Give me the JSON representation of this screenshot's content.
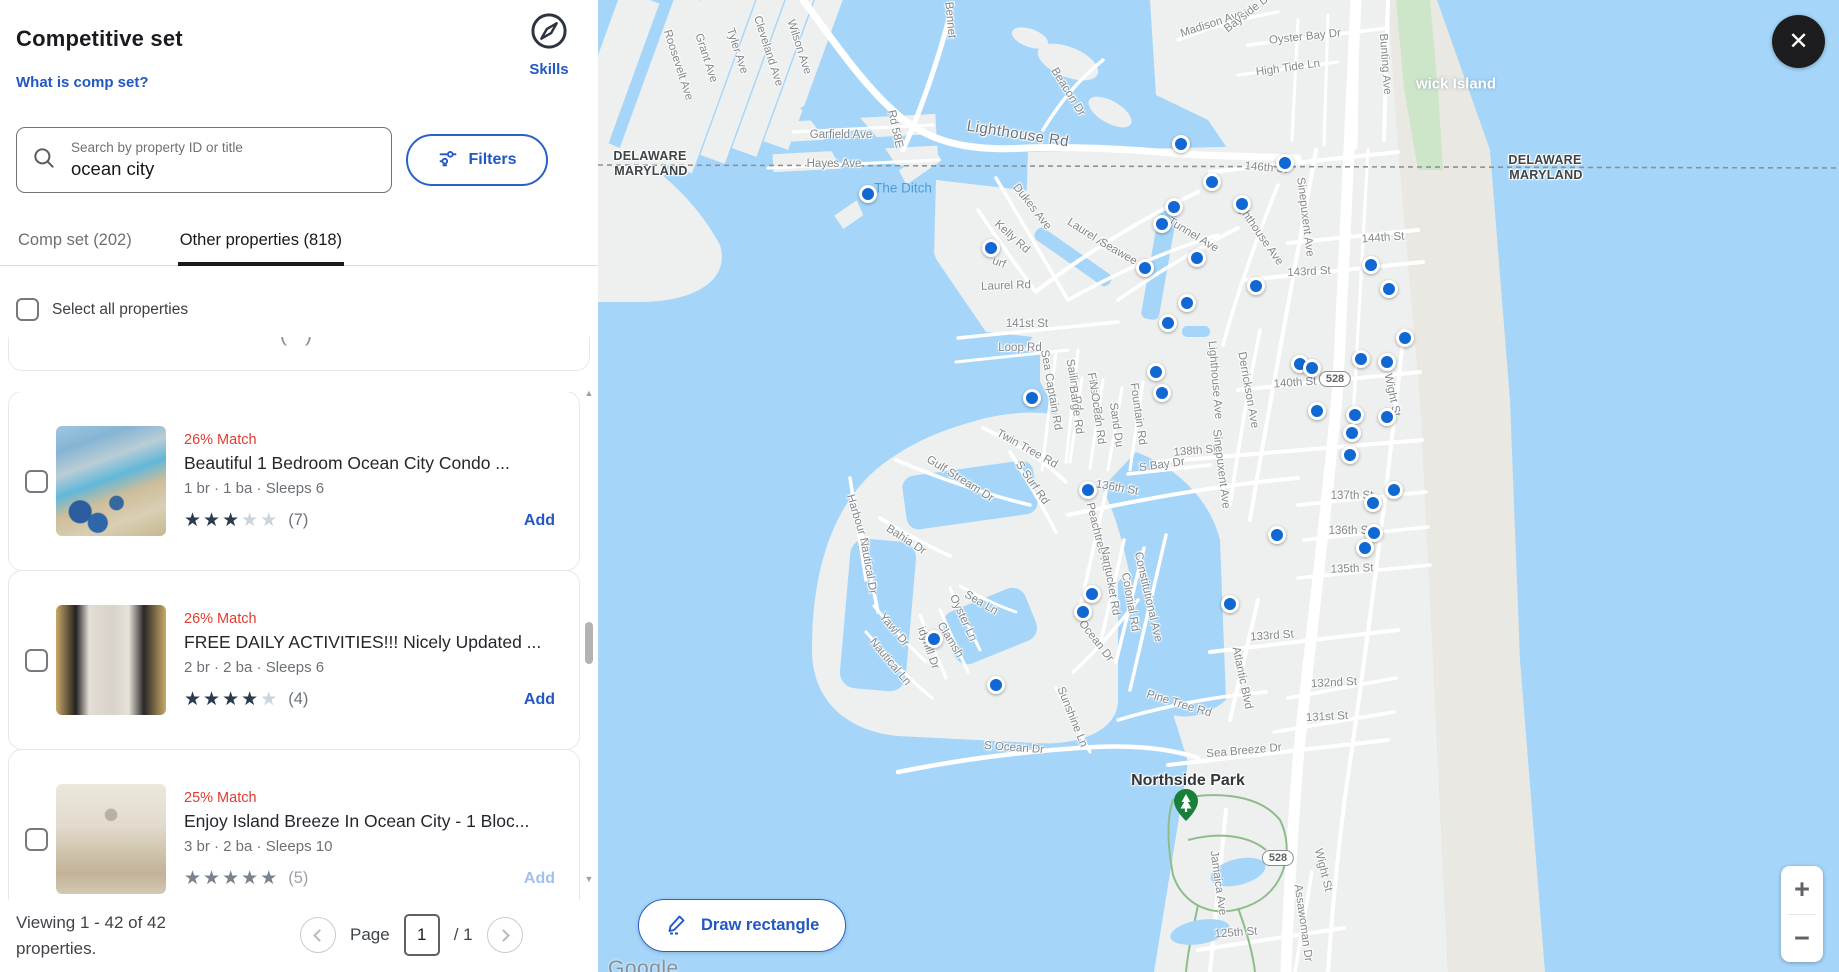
{
  "panel": {
    "title": "Competitive set",
    "help_link": "What is comp set?",
    "skills_label": "Skills",
    "search": {
      "placeholder": "Search by property ID or title",
      "value": "ocean city"
    },
    "filters_label": "Filters",
    "tabs": [
      {
        "label": "Comp set (202)",
        "active": false
      },
      {
        "label": "Other properties (818)",
        "active": true
      }
    ],
    "select_all_label": "Select all properties",
    "partial_glyph": "( )",
    "properties": [
      {
        "match": "26% Match",
        "title": "Beautiful 1 Bedroom Ocean City Condo ...",
        "specs": "1 br · 1 ba · Sleeps 6",
        "stars": 3,
        "reviews": "(7)",
        "add_label": "Add",
        "muted": false,
        "photo": "pool"
      },
      {
        "match": "26% Match",
        "title": "FREE DAILY ACTIVITIES!!! Nicely Updated ...",
        "specs": "2 br · 2 ba · Sleeps 6",
        "stars": 4,
        "reviews": "(4)",
        "add_label": "Add",
        "muted": false,
        "photo": "kitchen"
      },
      {
        "match": "25% Match",
        "title": "Enjoy Island Breeze In Ocean City - 1 Bloc...",
        "specs": "3 br · 2 ba · Sleeps 10",
        "stars": 5,
        "reviews": "(5)",
        "add_label": "Add",
        "muted": true,
        "photo": "living"
      }
    ],
    "footer": {
      "viewing_line1": "Viewing 1 - 42 of 42",
      "viewing_line2": "properties.",
      "page_label": "Page",
      "page_value": "1",
      "page_total": "/ 1"
    }
  },
  "map": {
    "draw_button_label": "Draw rectangle",
    "zoom_in": "+",
    "zoom_out": "−",
    "close_glyph": "✕",
    "attribution": "Google",
    "labels": [
      {
        "t": "DELAWARE",
        "x": 52,
        "y": 156,
        "r": 0,
        "c": "state"
      },
      {
        "t": "MARYLAND",
        "x": 53,
        "y": 171,
        "r": 0,
        "c": "state"
      },
      {
        "t": "DELAWARE",
        "x": 947,
        "y": 160,
        "r": 0,
        "c": "state"
      },
      {
        "t": "MARYLAND",
        "x": 948,
        "y": 175,
        "r": 0,
        "c": "state"
      },
      {
        "t": "wick Island",
        "x": 858,
        "y": 84,
        "r": 0,
        "c": "island"
      },
      {
        "t": "The Ditch",
        "x": 305,
        "y": 188,
        "r": 0,
        "c": "water"
      },
      {
        "t": "Northside Park",
        "x": 590,
        "y": 781,
        "r": 0,
        "c": "park"
      },
      {
        "t": "528",
        "x": 737,
        "y": 379,
        "r": 0,
        "c": "badge"
      },
      {
        "t": "528",
        "x": 680,
        "y": 858,
        "r": 0,
        "c": "badge"
      },
      {
        "t": "Lighthouse Rd",
        "x": 420,
        "y": 134,
        "r": 9,
        "c": "stlg"
      },
      {
        "t": "Roosevelt Ave",
        "x": 80,
        "y": 65,
        "r": 72,
        "c": "st"
      },
      {
        "t": "Grant Ave",
        "x": 108,
        "y": 58,
        "r": 72,
        "c": "st"
      },
      {
        "t": "Tyler Ave",
        "x": 139,
        "y": 51,
        "r": 72,
        "c": "st"
      },
      {
        "t": "Cleveland Ave",
        "x": 170,
        "y": 51,
        "r": 72,
        "c": "st"
      },
      {
        "t": "Wilson Ave",
        "x": 201,
        "y": 47,
        "r": 72,
        "c": "st"
      },
      {
        "t": "Bennet",
        "x": 352,
        "y": 20,
        "r": 85,
        "c": "st"
      },
      {
        "t": "Madison Ave",
        "x": 614,
        "y": 24,
        "r": -18,
        "c": "st"
      },
      {
        "t": "Bayside Dr",
        "x": 650,
        "y": 13,
        "r": -38,
        "c": "st"
      },
      {
        "t": "Oyster Bay Dr",
        "x": 707,
        "y": 37,
        "r": -6,
        "c": "st"
      },
      {
        "t": "High Tide Ln",
        "x": 690,
        "y": 68,
        "r": -8,
        "c": "st"
      },
      {
        "t": "Bunting Ave",
        "x": 787,
        "y": 64,
        "r": 86,
        "c": "st"
      },
      {
        "t": "Beacon Dr",
        "x": 470,
        "y": 92,
        "r": 58,
        "c": "st"
      },
      {
        "t": "Garfield Ave",
        "x": 243,
        "y": 135,
        "r": 0,
        "c": "st"
      },
      {
        "t": "Hayes Ave",
        "x": 236,
        "y": 164,
        "r": 0,
        "c": "st"
      },
      {
        "t": "Rd 58E",
        "x": 297,
        "y": 129,
        "r": 78,
        "c": "st"
      },
      {
        "t": "146th St",
        "x": 668,
        "y": 168,
        "r": 5,
        "c": "st"
      },
      {
        "t": "Dukes Ave",
        "x": 434,
        "y": 207,
        "r": 52,
        "c": "st"
      },
      {
        "t": "Kelly Rd",
        "x": 414,
        "y": 237,
        "r": 42,
        "c": "st"
      },
      {
        "t": "urf",
        "x": 401,
        "y": 263,
        "r": 20,
        "c": "st"
      },
      {
        "t": "Laurel Rd",
        "x": 408,
        "y": 286,
        "r": -2,
        "c": "st"
      },
      {
        "t": "Laurel Ave",
        "x": 493,
        "y": 236,
        "r": 33,
        "c": "st"
      },
      {
        "t": "Seawee",
        "x": 520,
        "y": 252,
        "r": 30,
        "c": "st"
      },
      {
        "t": "Tunnel Ave",
        "x": 595,
        "y": 235,
        "r": 31,
        "c": "st"
      },
      {
        "t": "Lighthouse Ave",
        "x": 660,
        "y": 232,
        "r": 55,
        "c": "st"
      },
      {
        "t": "Sinepuxent Ave",
        "x": 707,
        "y": 217,
        "r": 83,
        "c": "st"
      },
      {
        "t": "144th St",
        "x": 785,
        "y": 238,
        "r": -4,
        "c": "st"
      },
      {
        "t": "143rd St",
        "x": 711,
        "y": 272,
        "r": -3,
        "c": "st"
      },
      {
        "t": "141st St",
        "x": 429,
        "y": 324,
        "r": 0,
        "c": "st"
      },
      {
        "t": "Loop Rd",
        "x": 422,
        "y": 348,
        "r": 0,
        "c": "st"
      },
      {
        "t": "Sea Captain Rd",
        "x": 453,
        "y": 390,
        "r": 80,
        "c": "st"
      },
      {
        "t": "Sailing Rd",
        "x": 476,
        "y": 385,
        "r": 80,
        "c": "st"
      },
      {
        "t": "Fiesta Rd",
        "x": 497,
        "y": 397,
        "r": 80,
        "c": "st"
      },
      {
        "t": "Barge Rd",
        "x": 478,
        "y": 410,
        "r": 82,
        "c": "st"
      },
      {
        "t": "N Ocean Rd",
        "x": 499,
        "y": 413,
        "r": 82,
        "c": "st"
      },
      {
        "t": "Sand Du",
        "x": 518,
        "y": 425,
        "r": 82,
        "c": "st"
      },
      {
        "t": "Fountain Rd",
        "x": 540,
        "y": 414,
        "r": 82,
        "c": "st"
      },
      {
        "t": "Lighthouse Ave",
        "x": 617,
        "y": 380,
        "r": 85,
        "c": "st"
      },
      {
        "t": "Derrickson Ave",
        "x": 650,
        "y": 390,
        "r": 80,
        "c": "st"
      },
      {
        "t": "140th St",
        "x": 697,
        "y": 383,
        "r": -4,
        "c": "st"
      },
      {
        "t": "Wight St",
        "x": 794,
        "y": 395,
        "r": 78,
        "c": "st"
      },
      {
        "t": "138th St",
        "x": 597,
        "y": 451,
        "r": -5,
        "c": "st"
      },
      {
        "t": "S Bay Dr",
        "x": 564,
        "y": 465,
        "r": -8,
        "c": "st"
      },
      {
        "t": "Sinepuxent Ave",
        "x": 623,
        "y": 469,
        "r": 83,
        "c": "st"
      },
      {
        "t": "136th St",
        "x": 519,
        "y": 488,
        "r": 10,
        "c": "st"
      },
      {
        "t": "Twin Tree Rd",
        "x": 429,
        "y": 449,
        "r": 29,
        "c": "st"
      },
      {
        "t": "S Surf Rd",
        "x": 434,
        "y": 483,
        "r": 55,
        "c": "st"
      },
      {
        "t": "137th St",
        "x": 754,
        "y": 496,
        "r": 0,
        "c": "st"
      },
      {
        "t": "136th St",
        "x": 752,
        "y": 531,
        "r": 0,
        "c": "st"
      },
      {
        "t": "135th St",
        "x": 754,
        "y": 569,
        "r": -2,
        "c": "st"
      },
      {
        "t": "Gulf Stream Dr",
        "x": 362,
        "y": 479,
        "r": 32,
        "c": "st"
      },
      {
        "t": "Harbour Dr",
        "x": 260,
        "y": 522,
        "r": 73,
        "c": "st"
      },
      {
        "t": "Bahia Dr",
        "x": 308,
        "y": 540,
        "r": 33,
        "c": "st"
      },
      {
        "t": "Nautical Dr",
        "x": 270,
        "y": 566,
        "r": 80,
        "c": "st"
      },
      {
        "t": "Yawl Dr",
        "x": 296,
        "y": 630,
        "r": 50,
        "c": "st"
      },
      {
        "t": "idyhill Dr",
        "x": 330,
        "y": 648,
        "r": 70,
        "c": "st"
      },
      {
        "t": "Clamsh",
        "x": 352,
        "y": 640,
        "r": 58,
        "c": "st"
      },
      {
        "t": "Oyster Ln",
        "x": 365,
        "y": 618,
        "r": 65,
        "c": "st"
      },
      {
        "t": "Sea Ln",
        "x": 383,
        "y": 603,
        "r": 30,
        "c": "st"
      },
      {
        "t": "Nautical Ln",
        "x": 292,
        "y": 662,
        "r": 50,
        "c": "st"
      },
      {
        "t": "Sunshine Ln",
        "x": 474,
        "y": 717,
        "r": 68,
        "c": "st"
      },
      {
        "t": "Peachtree Rd",
        "x": 500,
        "y": 537,
        "r": 76,
        "c": "st"
      },
      {
        "t": "Nantucket Rd",
        "x": 512,
        "y": 581,
        "r": 80,
        "c": "st"
      },
      {
        "t": "Colonial Rd",
        "x": 532,
        "y": 602,
        "r": 80,
        "c": "st"
      },
      {
        "t": "Constitutional Ave",
        "x": 550,
        "y": 597,
        "r": 77,
        "c": "st"
      },
      {
        "t": "Ocean Dr",
        "x": 498,
        "y": 641,
        "r": 52,
        "c": "st"
      },
      {
        "t": "Atlantic Blvd",
        "x": 644,
        "y": 678,
        "r": 78,
        "c": "st"
      },
      {
        "t": "Pine Tree Rd",
        "x": 581,
        "y": 704,
        "r": 17,
        "c": "st"
      },
      {
        "t": "133rd St",
        "x": 674,
        "y": 636,
        "r": -4,
        "c": "st"
      },
      {
        "t": "132nd St",
        "x": 736,
        "y": 683,
        "r": -3,
        "c": "st"
      },
      {
        "t": "131st St",
        "x": 729,
        "y": 717,
        "r": -3,
        "c": "st"
      },
      {
        "t": "Sea Breeze Dr",
        "x": 646,
        "y": 751,
        "r": -5,
        "c": "st"
      },
      {
        "t": "S Ocean Dr",
        "x": 416,
        "y": 748,
        "r": 4,
        "c": "st"
      },
      {
        "t": "Jamaica Ave",
        "x": 620,
        "y": 883,
        "r": 82,
        "c": "st"
      },
      {
        "t": "Assawoman Dr",
        "x": 705,
        "y": 923,
        "r": 82,
        "c": "st"
      },
      {
        "t": "Wight St",
        "x": 725,
        "y": 870,
        "r": 76,
        "c": "st"
      },
      {
        "t": "125th St",
        "x": 638,
        "y": 933,
        "r": -4,
        "c": "st"
      }
    ],
    "markers": [
      [
        270,
        194
      ],
      [
        393,
        248
      ],
      [
        583,
        144
      ],
      [
        687,
        163
      ],
      [
        614,
        182
      ],
      [
        644,
        204
      ],
      [
        576,
        207
      ],
      [
        564,
        224
      ],
      [
        599,
        258
      ],
      [
        773,
        265
      ],
      [
        658,
        286
      ],
      [
        547,
        268
      ],
      [
        589,
        303
      ],
      [
        570,
        323
      ],
      [
        791,
        289
      ],
      [
        807,
        338
      ],
      [
        763,
        359
      ],
      [
        789,
        362
      ],
      [
        702,
        364
      ],
      [
        714,
        368
      ],
      [
        558,
        372
      ],
      [
        564,
        393
      ],
      [
        434,
        398
      ],
      [
        719,
        411
      ],
      [
        757,
        415
      ],
      [
        789,
        417
      ],
      [
        754,
        433
      ],
      [
        752,
        455
      ],
      [
        490,
        490
      ],
      [
        796,
        490
      ],
      [
        775,
        503
      ],
      [
        679,
        535
      ],
      [
        776,
        533
      ],
      [
        767,
        548
      ],
      [
        494,
        594
      ],
      [
        485,
        612
      ],
      [
        632,
        604
      ],
      [
        336,
        639
      ],
      [
        398,
        685
      ]
    ]
  },
  "colors": {
    "accent": "#2257c4",
    "match_red": "#e13c30",
    "star_filled": "#2b3b4e",
    "star_empty": "#ccd4dc",
    "marker_blue": "#1268d3",
    "water": "#a5d6fa"
  }
}
